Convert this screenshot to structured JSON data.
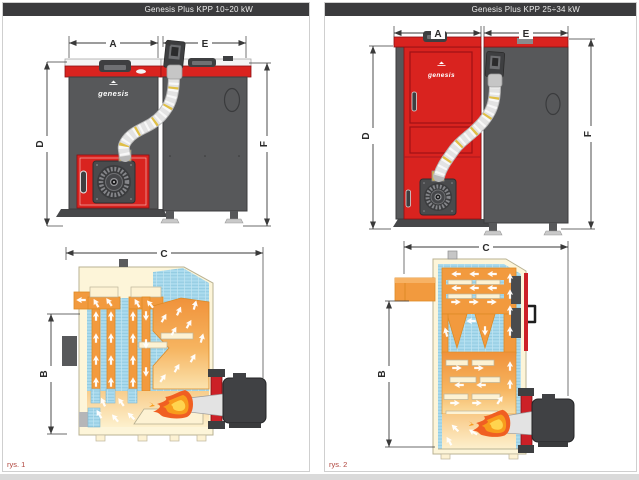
{
  "colors": {
    "accent_red": "#d9231f",
    "body_gray": "#58595b",
    "dark_gray": "#3e3f41",
    "header_bg": "#3b3b3d",
    "section_cream": "#fdf5d9",
    "flue_orange": "#f29a3e",
    "water_blue": "#abdbee",
    "flame_yellow": "#ffd44f",
    "figure_label_red": "#b0443c"
  },
  "panels": [
    {
      "title": "Genesis Plus KPP 10÷20 kW",
      "figure_label": "rys. 1",
      "brand_logo": "genesis",
      "dimensions": {
        "A": "A",
        "E": "E",
        "D": "D",
        "F": "F",
        "C": "C",
        "B": "B"
      }
    },
    {
      "title": "Genesis Plus KPP 25÷34 kW",
      "figure_label": "rys. 2",
      "brand_logo": "genesis",
      "dimensions": {
        "A": "A",
        "E": "E",
        "D": "D",
        "F": "F",
        "C": "C",
        "B": "B"
      }
    }
  ]
}
